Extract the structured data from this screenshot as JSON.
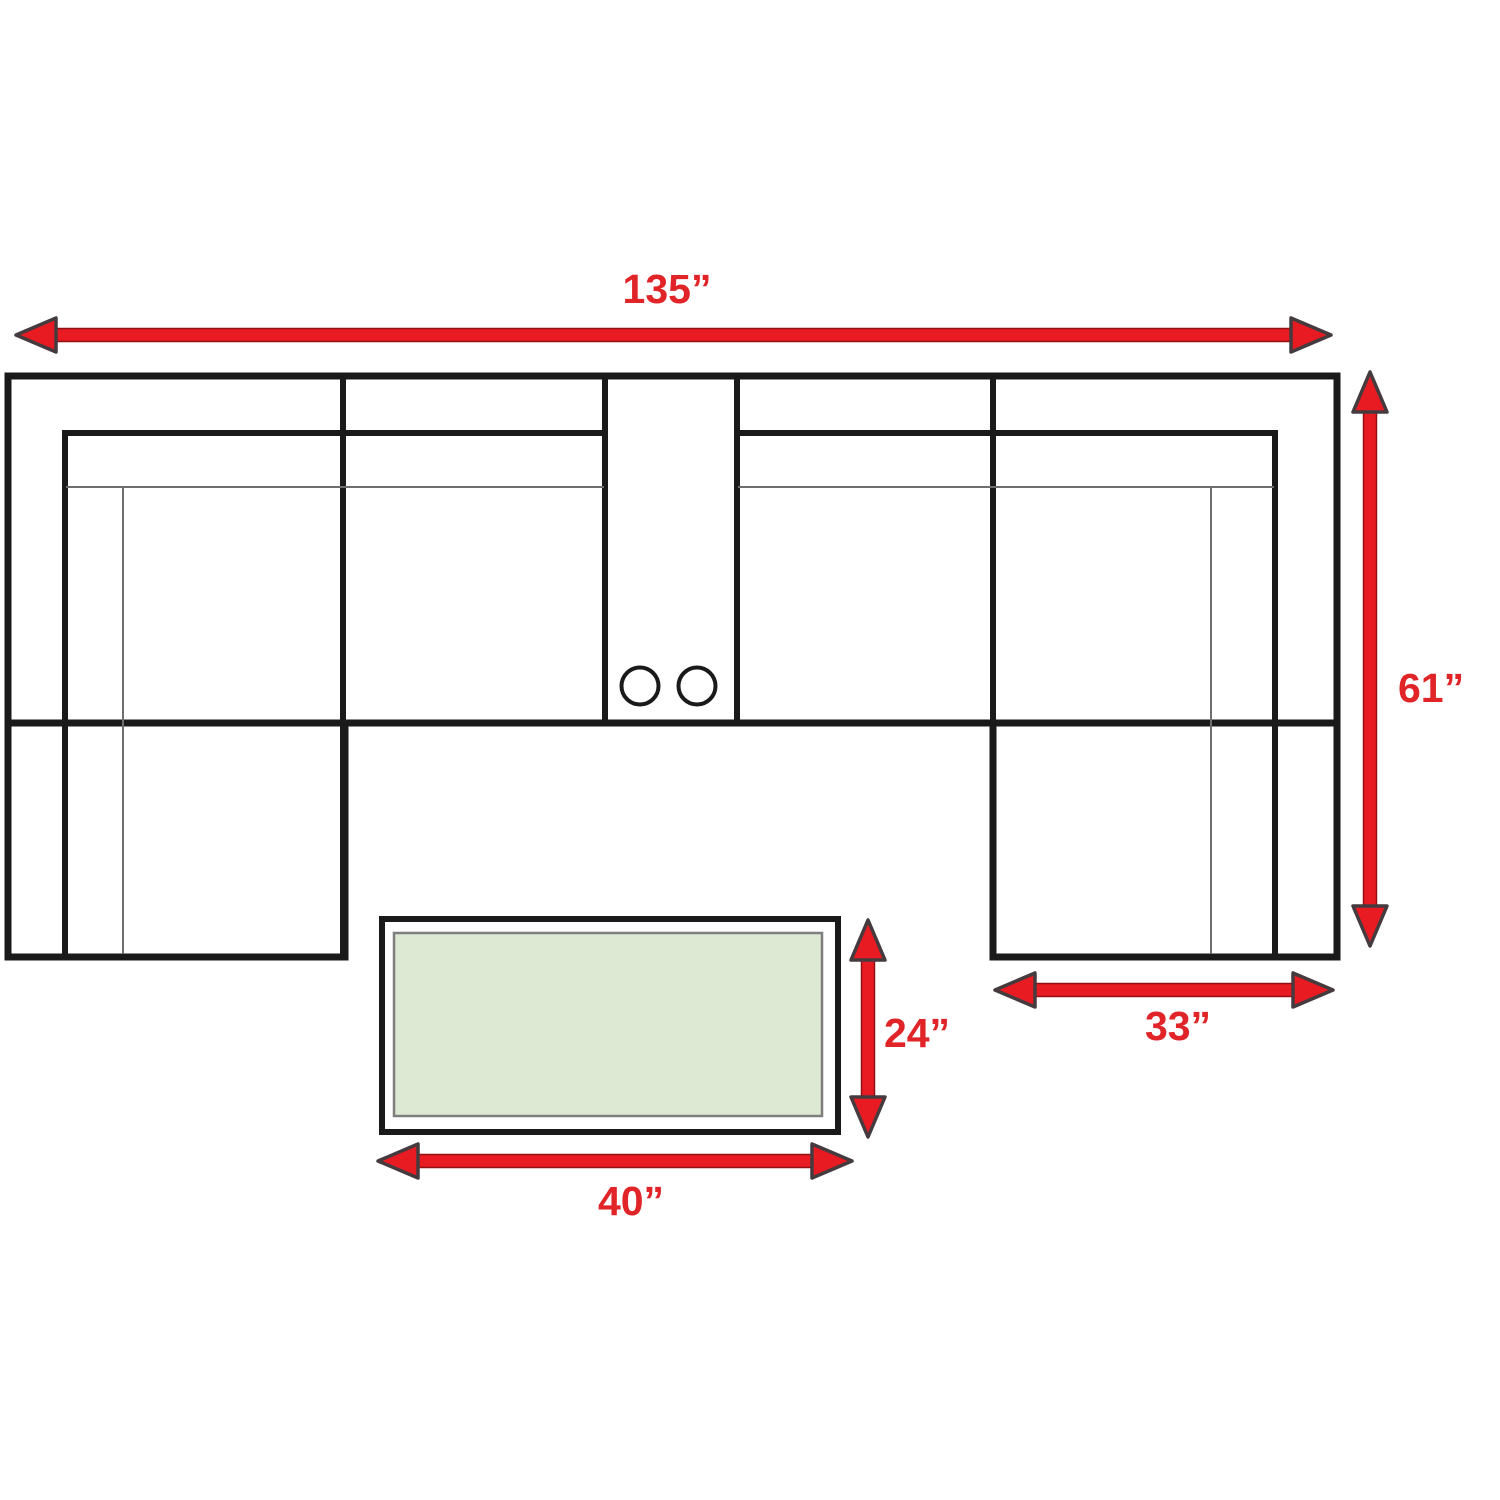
{
  "diagram": {
    "kind": "sectional-sofa-dimension-diagram",
    "view": "top-view-floor-plan",
    "dimensions": {
      "sofa_width": {
        "label": "135”",
        "orientation": "horizontal",
        "applies_to": "full-sectional-width"
      },
      "sofa_depth": {
        "label": "61”",
        "orientation": "vertical",
        "applies_to": "sectional-depth-with-chaise"
      },
      "chaise_width": {
        "label": "33”",
        "orientation": "horizontal",
        "applies_to": "right-chaise-width"
      },
      "table_depth": {
        "label": "24”",
        "orientation": "vertical",
        "applies_to": "coffee-table-depth"
      },
      "table_width": {
        "label": "40”",
        "orientation": "horizontal",
        "applies_to": "coffee-table-width"
      }
    },
    "parts": {
      "sofa": [
        "left-chaise-section",
        "left-seat-section",
        "center-console-with-two-cupholders",
        "right-seat-section",
        "right-chaise-section"
      ],
      "table": "rectangular-coffee-table"
    },
    "colors": {
      "arrow_red": "#e91b22",
      "label_red": "#e02428",
      "outline_black": "#1a1a1a",
      "thin_line_gray": "#6e6e6e",
      "table_fill_green": "#dde9d2",
      "table_border_gray": "#7f7f7f",
      "background": "#ffffff"
    }
  }
}
